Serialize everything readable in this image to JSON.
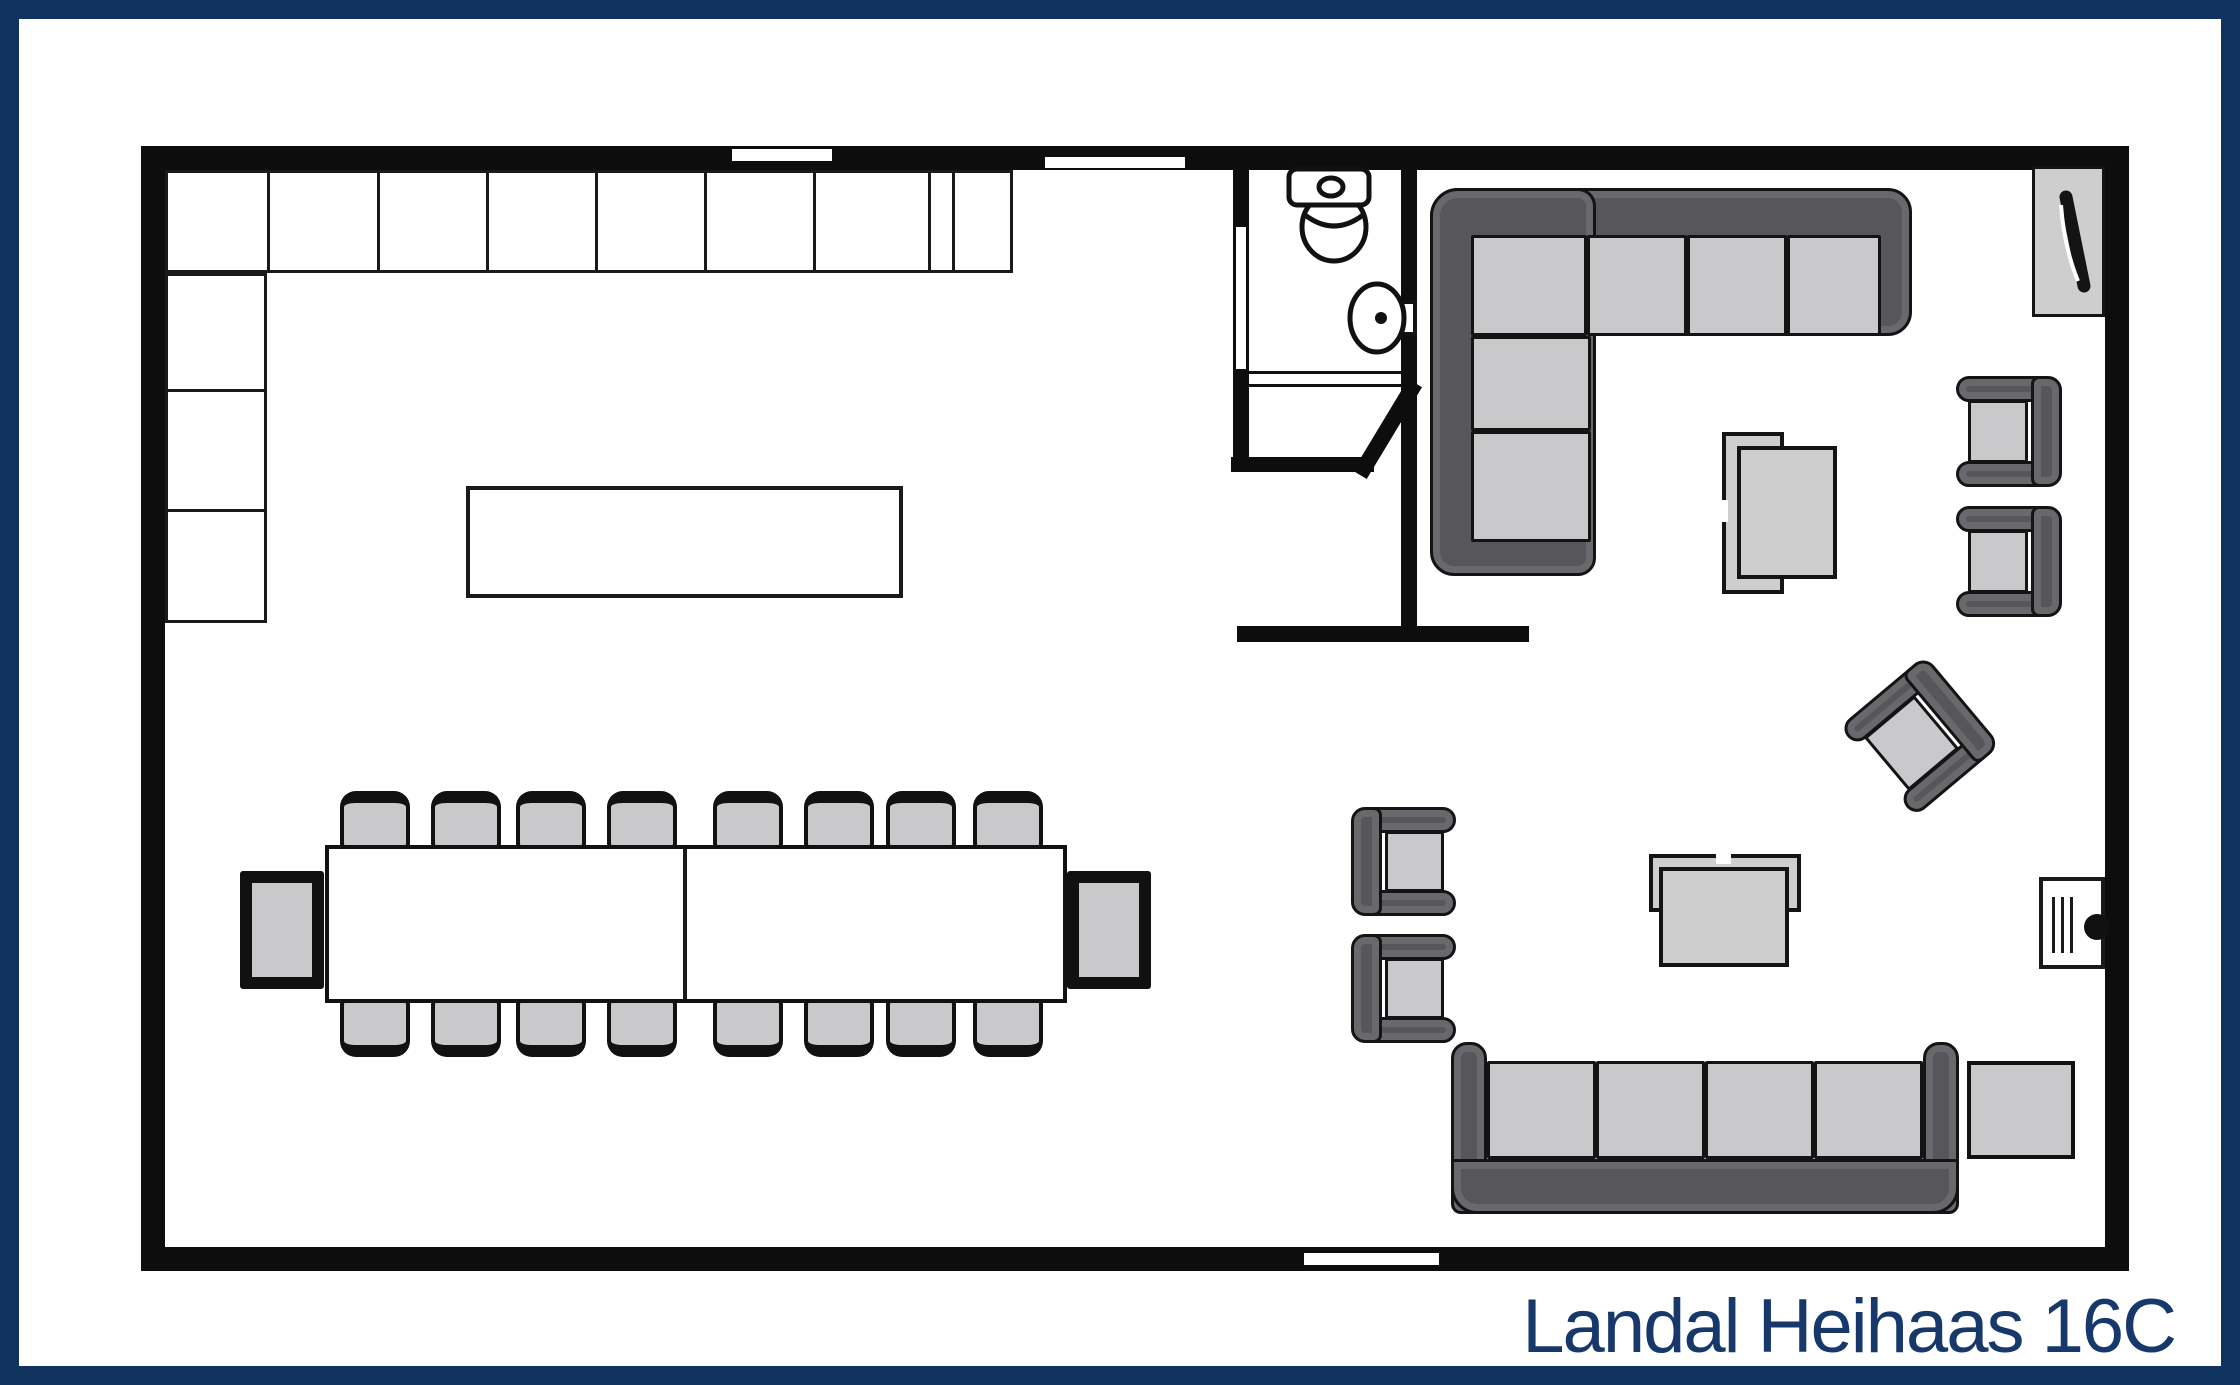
{
  "title": {
    "text": "Landal Heihaas 16C"
  },
  "colors": {
    "frame": "#10335f",
    "title": "#17386a",
    "walls": "#0d0d0d",
    "upholstery_dark": "#57575b",
    "upholstery_light": "#c9c9cb",
    "surface": "#cecece",
    "background": "#ffffff"
  },
  "plan": {
    "kitchen": {
      "counter_cells_top": 9,
      "counter_cells_side": 3,
      "islands": 1
    },
    "dining": {
      "tables": 2,
      "chairs_long_side": 8,
      "sides": 2,
      "end_tables": 2
    },
    "bathroom": {
      "fixtures": [
        "toilet-icon",
        "washbasin-icon"
      ],
      "door_openings": 1
    },
    "living": {
      "corner_sofa_seats": 6,
      "straight_sofa_seats": 4,
      "armchairs": 5,
      "coffee_tables": 2,
      "side_tables": 1,
      "icons": [
        "tv-icon",
        "stove-icon"
      ]
    },
    "openings": {
      "top_wall_windows": 2,
      "bottom_wall_doors": 1
    }
  }
}
